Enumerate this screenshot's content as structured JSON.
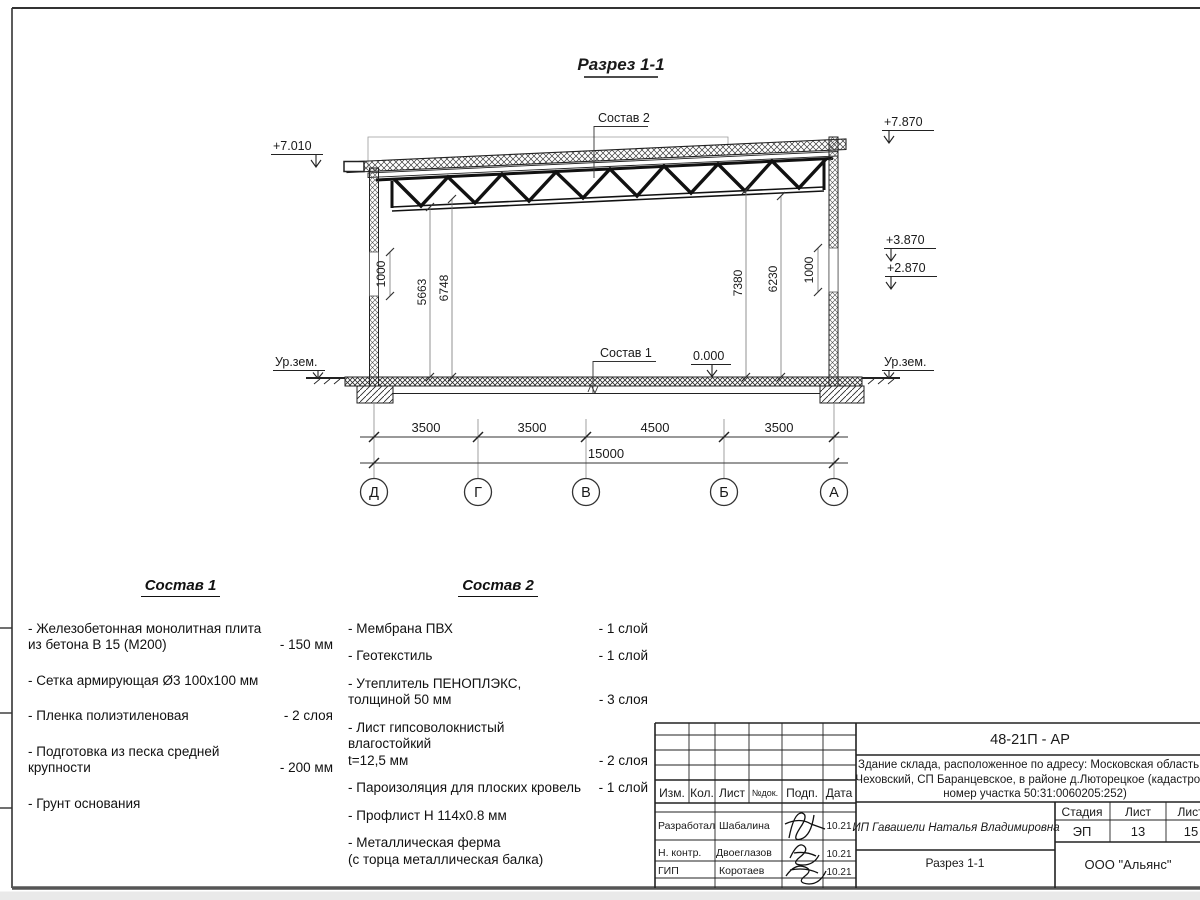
{
  "drawing": {
    "title": "Разрез 1-1",
    "elevations": {
      "left_top": "+7.010",
      "right_top": "+7.870",
      "right_upper": "+3.870",
      "right_lower": "+2.870",
      "zero": "0.000",
      "ground_left": "Ур.зем.",
      "ground_right": "Ур.зем."
    },
    "callouts": {
      "sostav1": "Состав 1",
      "sostav2": "Состав 2"
    },
    "vdims": {
      "left_parapet": "1000",
      "left_to_truss": "5663",
      "left_to_roof": "6748",
      "right_to_roof": "7380",
      "right_to_truss": "6230",
      "right_parapet": "1000"
    },
    "hdims": {
      "d_g": "3500",
      "g_v": "3500",
      "v_b": "4500",
      "b_a": "3500",
      "total": "15000"
    },
    "axes": [
      "Д",
      "Г",
      "В",
      "Б",
      "А"
    ]
  },
  "sostav1": {
    "title": "Состав 1",
    "items": [
      {
        "name": "- Железобетонная  монолитная плита\nиз бетона В 15 (М200)",
        "value": "- 150 мм"
      },
      {
        "name": "- Сетка армирующая Ø3 100х100 мм",
        "value": ""
      },
      {
        "name": "- Пленка полиэтиленовая",
        "value": "-  2 слоя"
      },
      {
        "name": "- Подготовка из песка средней\nкрупности",
        "value": "- 200 мм"
      },
      {
        "name": "- Грунт основания",
        "value": ""
      }
    ]
  },
  "sostav2": {
    "title": "Состав 2",
    "items": [
      {
        "name": "- Мембрана ПВХ",
        "value": "- 1 слой"
      },
      {
        "name": "- Геотекстиль",
        "value": "- 1 слой"
      },
      {
        "name": "- Утеплитель ПЕНОПЛЭКС,\nтолщиной 50 мм",
        "value": "- 3 слоя"
      },
      {
        "name": "- Лист гипсоволокнистый влагостойкий\nt=12,5 мм",
        "value": "- 2 слоя"
      },
      {
        "name": "- Пароизоляция для плоских кровель",
        "value": "- 1 слой"
      },
      {
        "name": "- Профлист Н 114х0.8 мм",
        "value": ""
      },
      {
        "name": "- Металлическая ферма\n(с торца металлическая балка)",
        "value": ""
      }
    ]
  },
  "titleblock": {
    "doc_code": "48-21П - АР",
    "address_lines": [
      "Здание склада, расположенное по адресу: Московская область, р",
      "Чеховский, СП Баранцевское, в районе д.Люторецкое  (кадастровы",
      "номер участка 50:31:0060205:252)"
    ],
    "columns": {
      "izm": "Изм.",
      "kol": "Кол.",
      "list": "Лист",
      "ndok": "№док.",
      "podp": "Подп.",
      "data": "Дата"
    },
    "rows": [
      {
        "role": "Разработал",
        "name": "Шабалина",
        "date": "10.21"
      },
      {
        "role": "Н. контр.",
        "name": "Двоеглазов",
        "date": "10.21"
      },
      {
        "role": "ГИП",
        "name": "Коротаев",
        "date": "10.21"
      }
    ],
    "client": "ИП Гавашели Наталья Владимировна",
    "stage_label": "Стадия",
    "sheet_label": "Лист",
    "sheets_label": "Листов",
    "stage": "ЭП",
    "sheet": "13",
    "sheets": "15",
    "section_name": "Разрез 1-1",
    "company": "ООО \"Альянс\""
  }
}
